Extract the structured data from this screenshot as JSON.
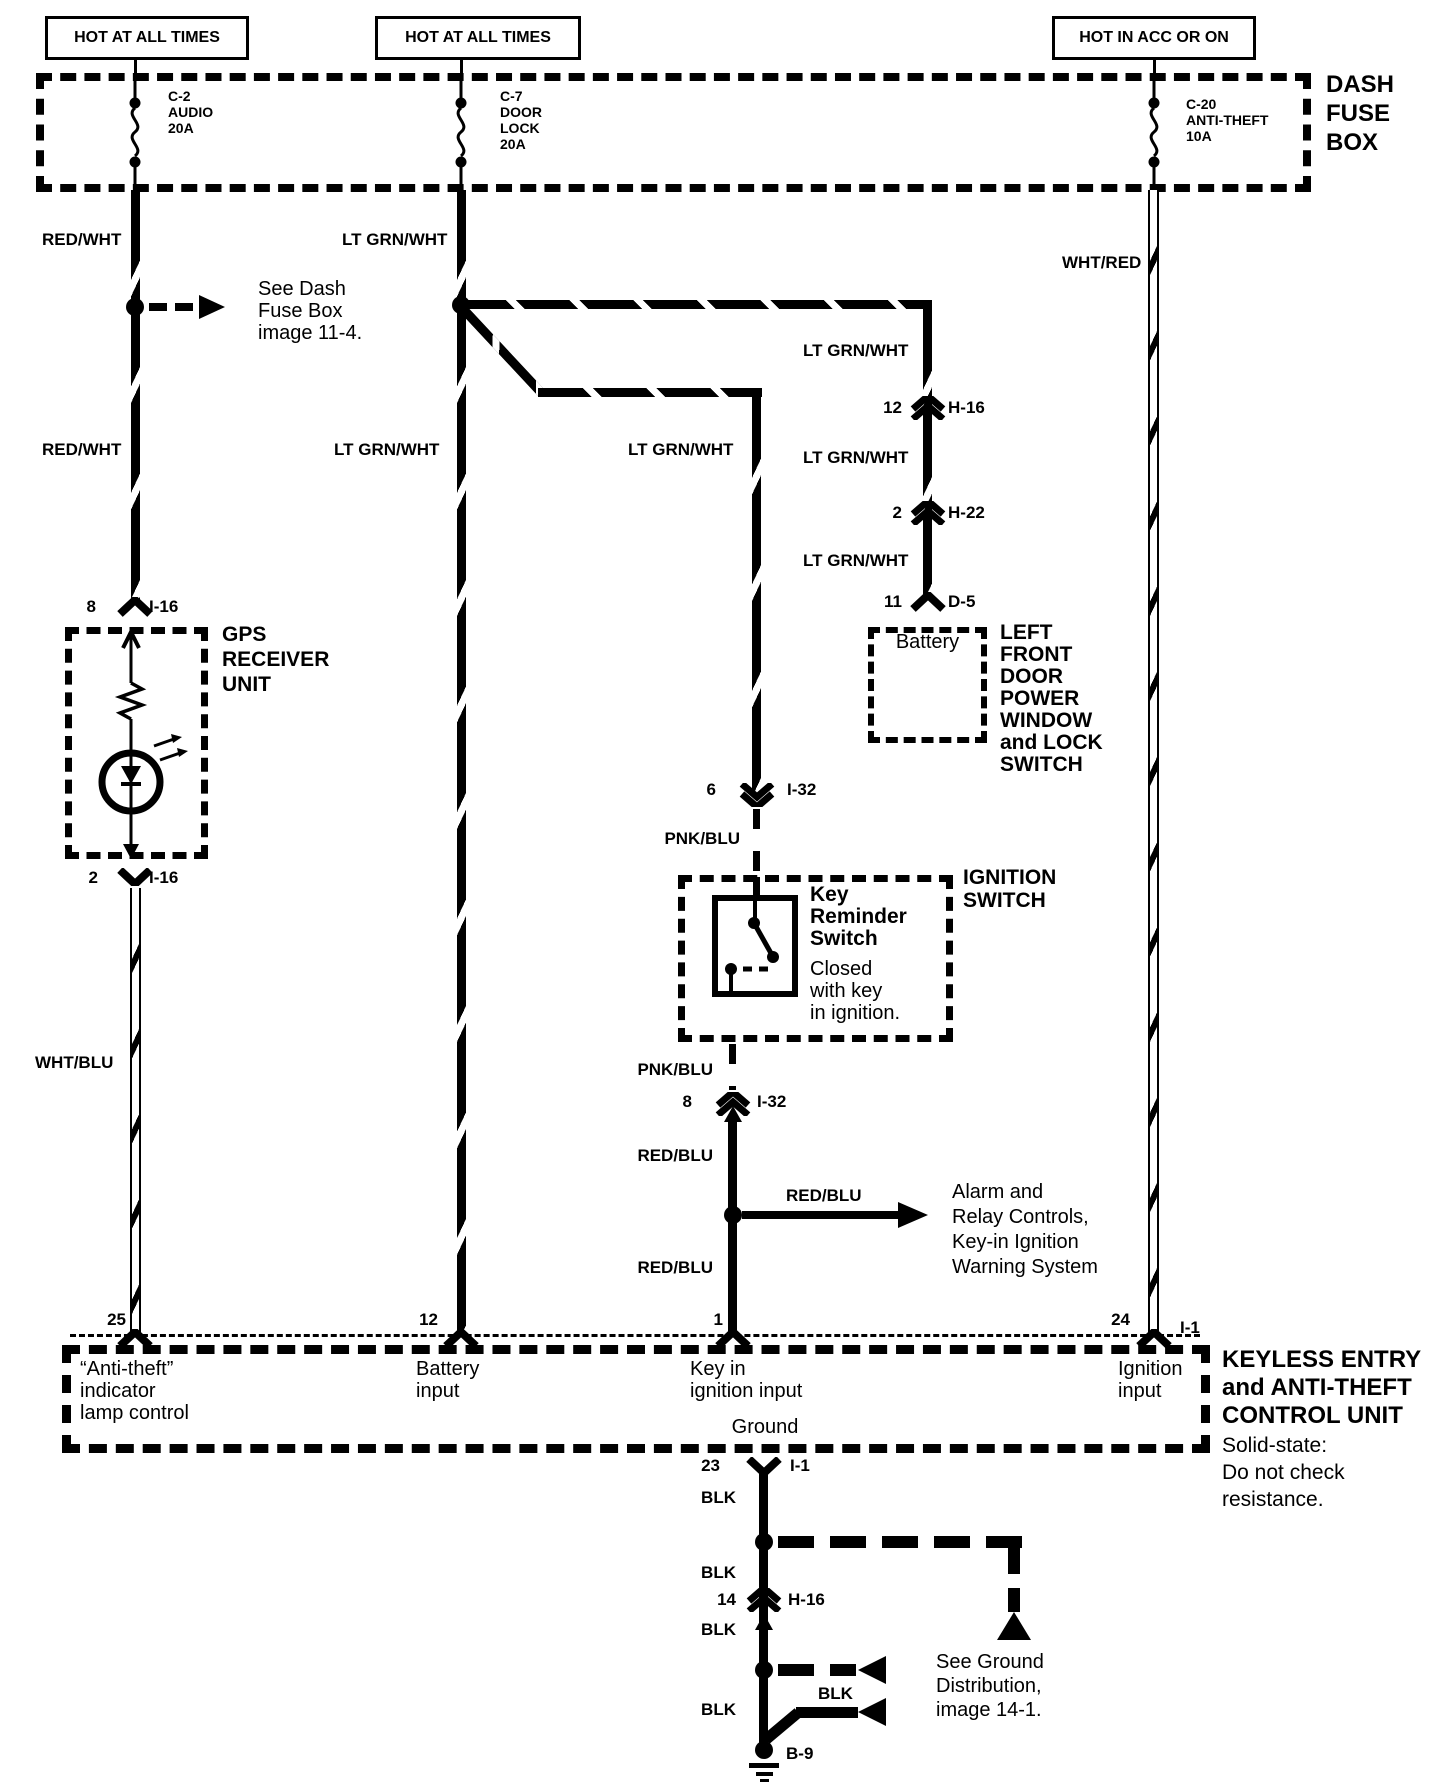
{
  "header": {
    "hot1": "HOT AT ALL TIMES",
    "hot2": "HOT AT ALL TIMES",
    "hot3": "HOT IN ACC OR ON"
  },
  "fusebox": {
    "name": "DASH\nFUSE\nBOX",
    "fuse1": "C-2\nAUDIO\n20A",
    "fuse2": "C-7\nDOOR\nLOCK\n20A",
    "fuse3": "C-20\nANTI-THEFT\n10A"
  },
  "wires": {
    "red_wht_1": "RED/WHT",
    "red_wht_2": "RED/WHT",
    "lt_grn_wht_1": "LT GRN/WHT",
    "lt_grn_wht_2": "LT GRN/WHT",
    "lt_grn_wht_3": "LT GRN/WHT",
    "lt_grn_wht_4": "LT GRN/WHT",
    "lt_grn_wht_5": "LT GRN/WHT",
    "lt_grn_wht_6": "LT GRN/WHT",
    "wht_red": "WHT/RED",
    "wht_blu": "WHT/BLU",
    "pnk_blu_1": "PNK/BLU",
    "pnk_blu_2": "PNK/BLU",
    "red_blu_1": "RED/BLU",
    "red_blu_2": "RED/BLU",
    "red_blu_3": "RED/BLU",
    "blk_1": "BLK",
    "blk_2": "BLK",
    "blk_3": "BLK",
    "blk_4": "BLK",
    "blk_5": "BLK"
  },
  "notes": {
    "see_dash": "See Dash\nFuse Box\nimage 11-4.",
    "alarm": "Alarm and\nRelay Controls,\nKey-in Ignition\nWarning System",
    "see_ground": "See Ground\nDistribution,\nimage 14-1."
  },
  "connectors": {
    "i16_8": {
      "pin": "8",
      "name": "I-16"
    },
    "i16_2": {
      "pin": "2",
      "name": "I-16"
    },
    "h16_12": {
      "pin": "12",
      "name": "H-16"
    },
    "h22_2": {
      "pin": "2",
      "name": "H-22"
    },
    "d5_11": {
      "pin": "11",
      "name": "D-5"
    },
    "i32_6": {
      "pin": "6",
      "name": "I-32"
    },
    "i32_8": {
      "pin": "8",
      "name": "I-32"
    },
    "i1_24": {
      "pin": "24",
      "name": "I-1"
    },
    "i1_23": {
      "pin": "23",
      "name": "I-1"
    },
    "h16_14": {
      "pin": "14",
      "name": "H-16"
    },
    "b9": {
      "name": "B-9"
    },
    "p25": "25",
    "p12": "12",
    "p1": "1"
  },
  "gps": {
    "name": "GPS\nRECEIVER\nUNIT"
  },
  "door_switch": {
    "position": "Battery",
    "name": "LEFT\nFRONT\nDOOR\nPOWER\nWINDOW\nand LOCK\nSWITCH"
  },
  "ignition": {
    "name": "IGNITION\nSWITCH",
    "switch": "Key\nReminder\nSwitch",
    "desc": "Closed\nwith key\nin ignition."
  },
  "control_unit": {
    "name": "KEYLESS ENTRY\nand ANTI-THEFT\nCONTROL UNIT",
    "desc": "Solid-state:\nDo not check\nresistance.",
    "pin25": "“Anti-theft”\nindicator\nlamp control",
    "pin12": "Battery\ninput",
    "pin1": "Key in\nignition input",
    "pin24": "Ignition\ninput",
    "ground": "Ground"
  }
}
